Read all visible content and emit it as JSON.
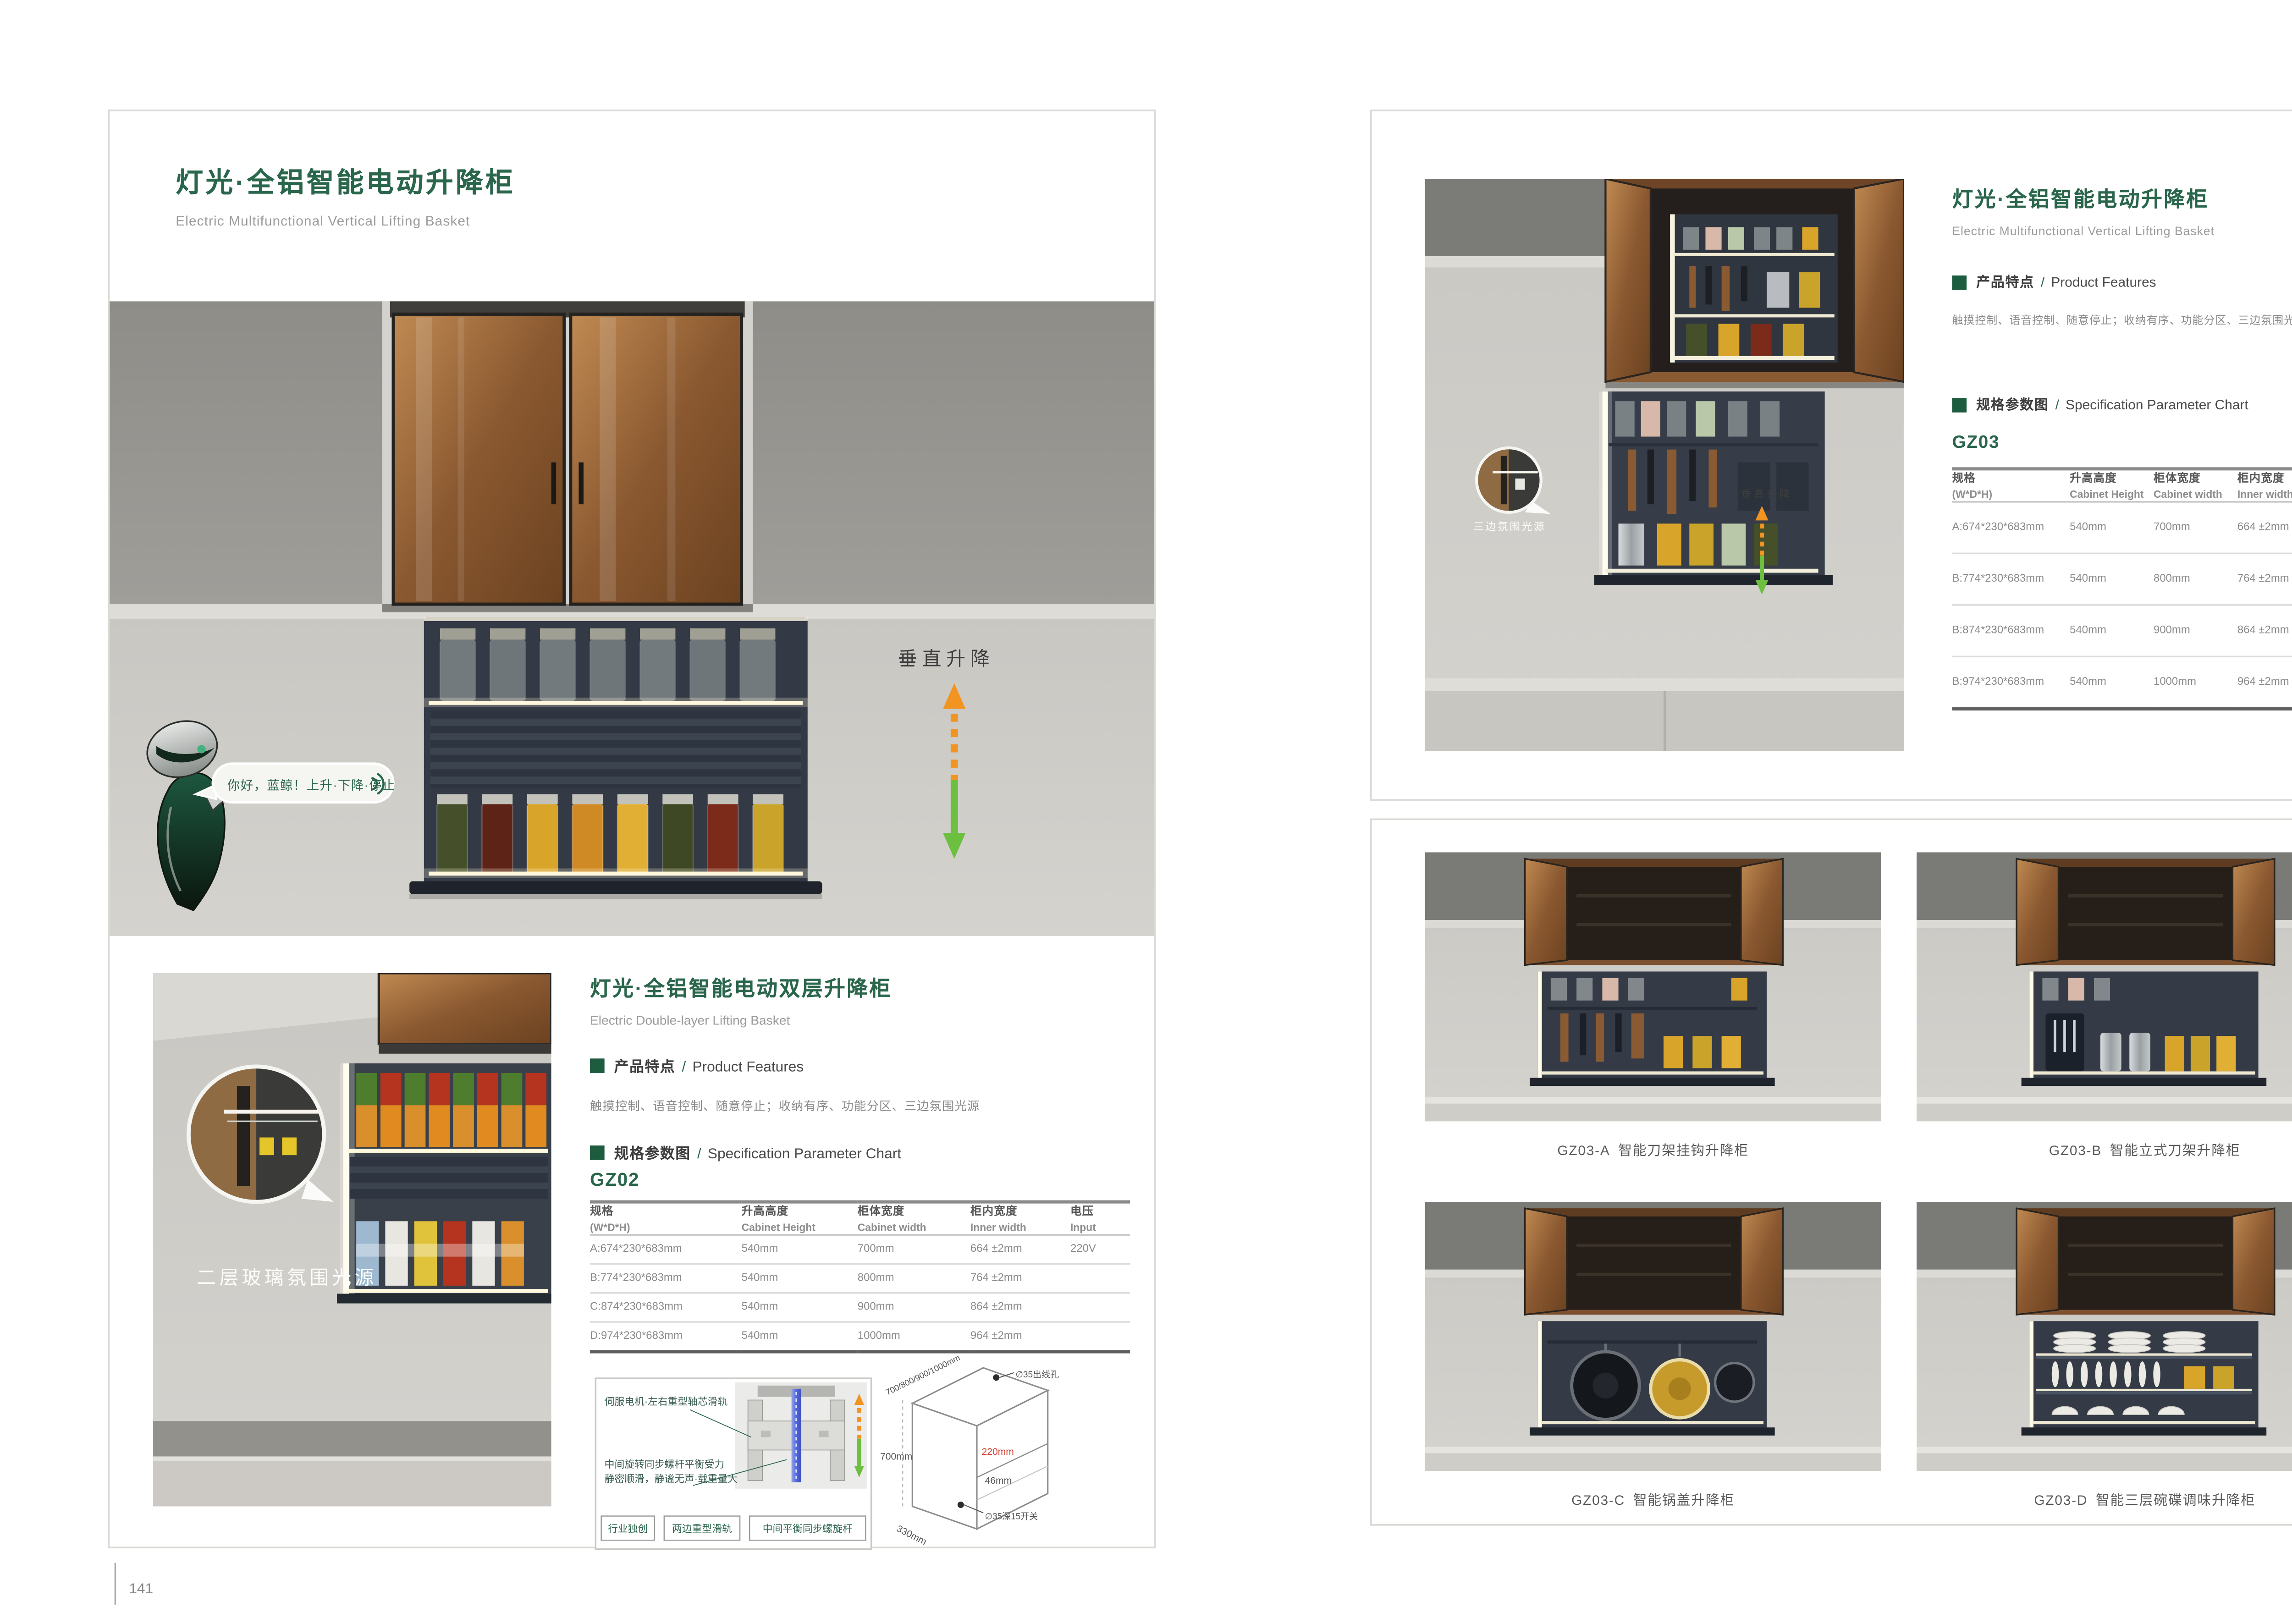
{
  "colors": {
    "brand_green": "#2A664C",
    "heading_square_green": "#1E5C40",
    "arrow_orange": "#F29422",
    "arrow_green": "#6CBF3F",
    "dim_red": "#D43A2A"
  },
  "left_page": {
    "page_number": "141",
    "title": "灯光·全铝智能电动升降柜",
    "subtitle": "Electric Multifunctional Vertical Lifting Basket",
    "hero": {
      "speech_text": "你好，蓝鲸！上升·下降·停止",
      "lift_label": "垂直升降"
    },
    "section2": {
      "title": "灯光·全铝智能电动双层升降柜",
      "subtitle": "Electric Double-layer Lifting Basket",
      "features_cn": "产品特点",
      "features_slash": "/",
      "features_en": "Product Features",
      "features_text": "触摸控制、语音控制、随意停止；收纳有序、功能分区、三边氛围光源",
      "spec_cn": "规格参数图",
      "spec_slash": "/",
      "spec_en": "Specification Parameter Chart",
      "model": "GZ02",
      "photo_callout": "二层玻璃氛围光源"
    },
    "mech_diagram": {
      "label_top": "伺服电机·左右重型轴芯滑轨",
      "label_mid_1": "中间旋转同步螺杆平衡受力",
      "label_mid_2": "静密顺滑，静谧无声·载重量大",
      "tags": [
        "行业独创",
        "两边重型滑轨",
        "中间平衡同步螺旋杆"
      ]
    },
    "cabinet_diagram": {
      "dim_top": "700/800/900/1000mm",
      "dim_left": "700mm",
      "dim_depth": "330mm",
      "dim_inner": "220mm",
      "dim_gap": "46mm",
      "hole_top": "∅35出线孔",
      "hole_bottom": "∅35深15开关"
    }
  },
  "right_page": {
    "page_number": "142",
    "title": "灯光·全铝智能电动升降柜",
    "subtitle": "Electric Multifunctional Vertical Lifting Basket",
    "features_cn": "产品特点",
    "features_slash": "/",
    "features_en": "Product Features",
    "features_text": "触摸控制、语音控制、随意停止；收纳有序、功能分区、三边氛围光源",
    "spec_cn": "规格参数图",
    "spec_slash": "/",
    "spec_en": "Specification Parameter Chart",
    "model": "GZ03",
    "photo_callout": "三边氛围光源",
    "lift_label": "垂直升降",
    "products": [
      {
        "code": "GZ03-A",
        "name": "智能刀架挂钩升降柜"
      },
      {
        "code": "GZ03-B",
        "name": "智能立式刀架升降柜"
      },
      {
        "code": "GZ03-C",
        "name": "智能锅盖升降柜"
      },
      {
        "code": "GZ03-D",
        "name": "智能三层碗碟调味升降柜"
      }
    ]
  },
  "spec_table": {
    "headers": [
      {
        "cn": "规格",
        "en": "(W*D*H)"
      },
      {
        "cn": "升高高度",
        "en": "Cabinet Height"
      },
      {
        "cn": "柜体宽度",
        "en": "Cabinet width"
      },
      {
        "cn": "柜内宽度",
        "en": "Inner width"
      },
      {
        "cn": "电压",
        "en": "Input"
      }
    ],
    "gz02_rows": [
      [
        "A:674*230*683mm",
        "540mm",
        "700mm",
        "664 ±2mm",
        "220V"
      ],
      [
        "B:774*230*683mm",
        "540mm",
        "800mm",
        "764 ±2mm",
        ""
      ],
      [
        "C:874*230*683mm",
        "540mm",
        "900mm",
        "864 ±2mm",
        ""
      ],
      [
        "D:974*230*683mm",
        "540mm",
        "1000mm",
        "964 ±2mm",
        ""
      ]
    ],
    "gz03_rows": [
      [
        "A:674*230*683mm",
        "540mm",
        "700mm",
        "664 ±2mm",
        "220V"
      ],
      [
        "B:774*230*683mm",
        "540mm",
        "800mm",
        "764 ±2mm",
        ""
      ],
      [
        "B:874*230*683mm",
        "540mm",
        "900mm",
        "864 ±2mm",
        ""
      ],
      [
        "B:974*230*683mm",
        "540mm",
        "1000mm",
        "964 ±2mm",
        ""
      ]
    ]
  }
}
